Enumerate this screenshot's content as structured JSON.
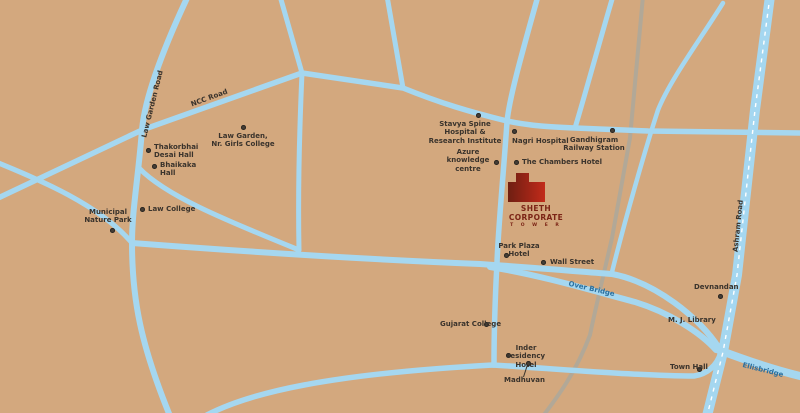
{
  "map": {
    "title": "Sheth Corporate Tower location map",
    "colors": {
      "background": "#d3a87e",
      "road": "#a5d7f0",
      "railway": "#b2a897",
      "label_text": "#3a332c",
      "road_label_blue": "#2b6f9e",
      "brand_red_dark": "#6e1f12",
      "brand_red_bright": "#c22b1a"
    },
    "road_labels": [
      {
        "id": "law-garden-road",
        "text": "Law Garden Road"
      },
      {
        "id": "ncc-road",
        "text": "NCC Road"
      },
      {
        "id": "over-bridge",
        "text": "Over Bridge"
      },
      {
        "id": "ellisbridge",
        "text": "Ellisbridge"
      },
      {
        "id": "ashram-road",
        "text": "Ashram Road"
      }
    ],
    "pois": [
      {
        "label": "Thakorbhai\nDesai Hall"
      },
      {
        "label": "Bhaikaka\nHall"
      },
      {
        "label": "Law Garden,\nNr. Girls College"
      },
      {
        "label": "Municipal\nNature Park"
      },
      {
        "label": "Law College"
      },
      {
        "label": "Stavya Spine Hospital &\nResearch Institute"
      },
      {
        "label": "Nagri Hospital"
      },
      {
        "label": "Gandhigram\nRailway Station"
      },
      {
        "label": "Azure\nknowledge\ncentre"
      },
      {
        "label": "The Chambers Hotel"
      },
      {
        "label": "Park Plaza\nHotel"
      },
      {
        "label": "Wall Street"
      },
      {
        "label": "Gujarat College"
      },
      {
        "label": "Inder residency\nHotel"
      },
      {
        "label": "Madhuvan"
      },
      {
        "label": "Devnandan"
      },
      {
        "label": "M. J. Library"
      },
      {
        "label": "Town Hall"
      }
    ],
    "brand": {
      "name": "SHETH CORPORATE",
      "sub": "T O W E R"
    }
  }
}
